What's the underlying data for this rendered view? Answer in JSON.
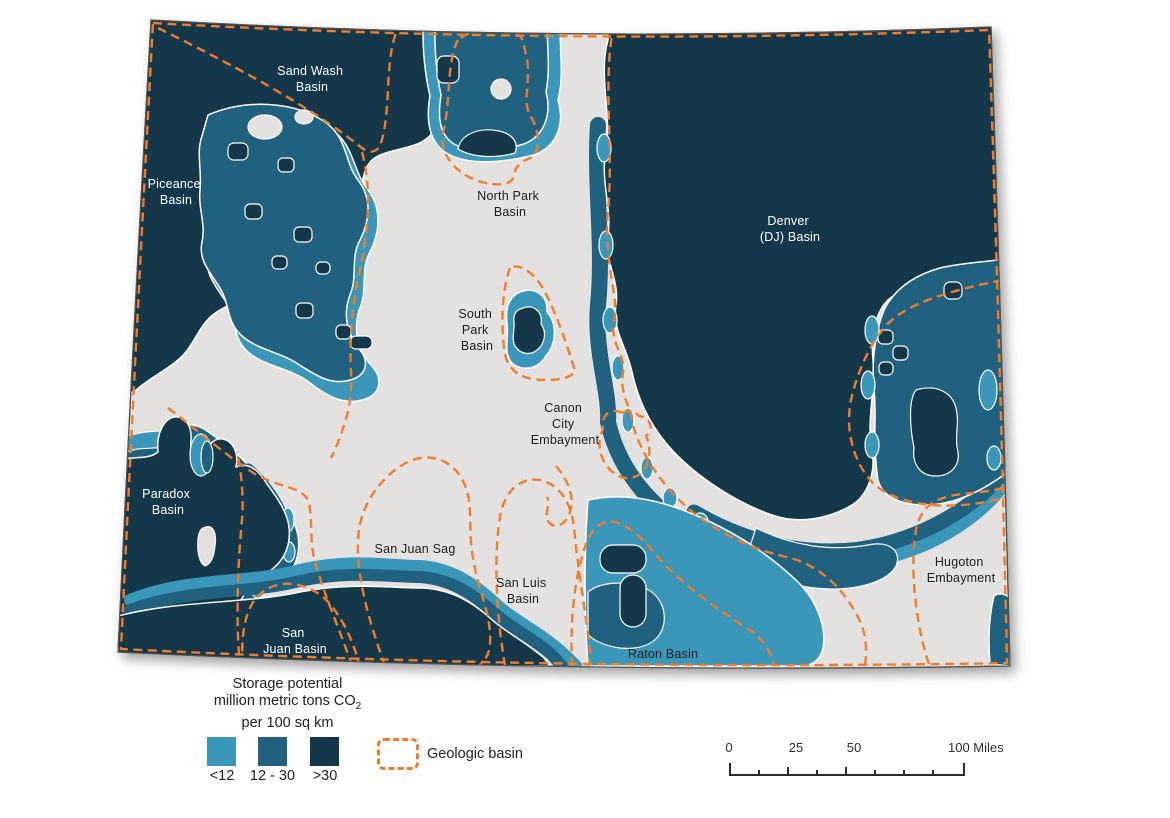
{
  "colors": {
    "class_lt12": "#3A97BA",
    "class_mid": "#1F617F",
    "class_gt30": "#14374A",
    "state_fill": "#E3E2E0",
    "basin_outline": "#F07D2B",
    "map_border": "#55544F",
    "label_dark": "#1D1D1B",
    "label_light": "#FFFFFF",
    "scalebar": "#2B2B2B"
  },
  "map": {
    "labels": [
      {
        "id": "sand-wash-basin",
        "lines": [
          "Sand Wash",
          "Basin"
        ]
      },
      {
        "id": "piceance-basin",
        "lines": [
          "Piceance",
          "Basin"
        ]
      },
      {
        "id": "north-park-basin",
        "lines": [
          "North Park",
          "Basin"
        ]
      },
      {
        "id": "denver-dj-basin",
        "lines": [
          "Denver",
          "(DJ) Basin"
        ]
      },
      {
        "id": "south-park-basin",
        "lines": [
          "South",
          "Park",
          "Basin"
        ]
      },
      {
        "id": "canon-city-embayment",
        "lines": [
          "Canon",
          "City",
          "Embayment"
        ]
      },
      {
        "id": "paradox-basin",
        "lines": [
          "Paradox",
          "Basin"
        ]
      },
      {
        "id": "san-juan-sag",
        "lines": [
          "San Juan Sag"
        ]
      },
      {
        "id": "san-luis-basin",
        "lines": [
          "San Luis",
          "Basin"
        ]
      },
      {
        "id": "hugoton-embayment",
        "lines": [
          "Hugoton",
          "Embayment"
        ]
      },
      {
        "id": "san-juan-basin",
        "lines": [
          "San",
          "Juan Basin"
        ]
      },
      {
        "id": "raton-basin",
        "lines": [
          "Raton Basin"
        ]
      }
    ]
  },
  "legend": {
    "title_line1": "Storage potential",
    "title_line2_prefix": "million metric tons CO",
    "title_line2_subscript": "2",
    "title_line3": "per 100 sq km",
    "classes": [
      {
        "label": "<12"
      },
      {
        "label": "12 - 30"
      },
      {
        "label": ">30"
      }
    ],
    "geologic_basin_label": "Geologic basin"
  },
  "scale_bar": {
    "tick_labels": [
      "0",
      "25",
      "50"
    ],
    "end_label": "100 Miles"
  }
}
